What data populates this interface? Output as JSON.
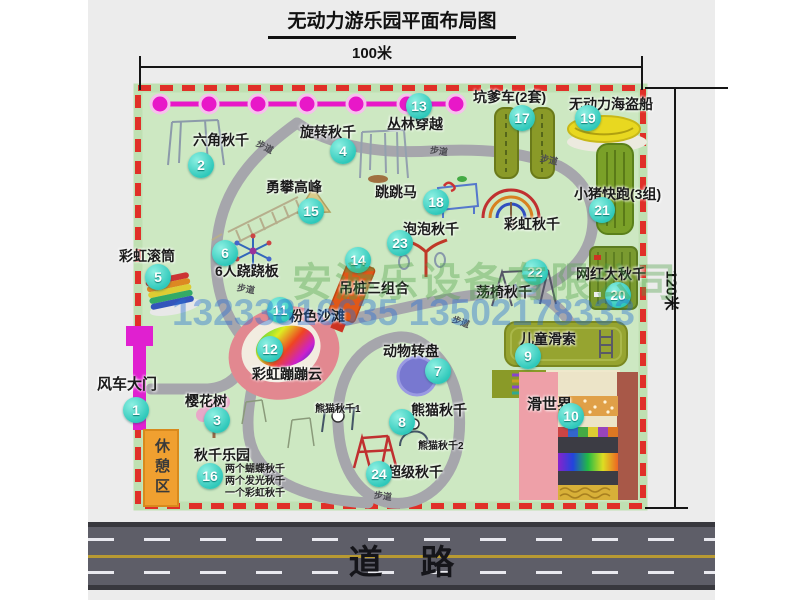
{
  "title": "无动力游乐园平面布局图",
  "dimensions": {
    "width": "100米",
    "height": "120米"
  },
  "road_label": "道    路",
  "walkway_label": "步道",
  "watermark": {
    "company": "安游乐设备有限公司",
    "phone": "13233816635 13502178333"
  },
  "rest_area_label": "休憩区",
  "rainbow_swing_label": "彩虹秋千",
  "panda_swing_1": "熊猫秋千1",
  "panda_swing_2": "熊猫秋千2",
  "swing_park_notes": {
    "n1": "两个蝴蝶秋千",
    "n2": "两个发光秋千",
    "n3": "一个彩虹秋千"
  },
  "attractions": [
    {
      "num": "1",
      "name": "风车大门"
    },
    {
      "num": "2",
      "name": "六角秋千"
    },
    {
      "num": "3",
      "name": "樱花树"
    },
    {
      "num": "4",
      "name": "旋转秋千"
    },
    {
      "num": "5",
      "name": "彩虹滚筒"
    },
    {
      "num": "6",
      "name": "6人跷跷板"
    },
    {
      "num": "7",
      "name": "动物转盘"
    },
    {
      "num": "8",
      "name": "熊猫秋千"
    },
    {
      "num": "9",
      "name": "儿童滑索"
    },
    {
      "num": "10",
      "name": "滑世界"
    },
    {
      "num": "11",
      "name": "粉色沙滩"
    },
    {
      "num": "12",
      "name": "彩虹蹦蹦云"
    },
    {
      "num": "13",
      "name": "丛林穿越"
    },
    {
      "num": "14",
      "name": "吊桩三组合"
    },
    {
      "num": "15",
      "name": "勇攀高峰"
    },
    {
      "num": "16",
      "name": "秋千乐园"
    },
    {
      "num": "17",
      "name": "坑爹车(2套)"
    },
    {
      "num": "18",
      "name": "跳跳马"
    },
    {
      "num": "19",
      "name": "无动力海盗船"
    },
    {
      "num": "20",
      "name": "网红大秋千"
    },
    {
      "num": "21",
      "name": "小猪快跑(3组)"
    },
    {
      "num": "22",
      "name": "荡椅秋千"
    },
    {
      "num": "23",
      "name": "泡泡秋千"
    },
    {
      "num": "24",
      "name": "超级秋千"
    }
  ],
  "colors": {
    "park_fill": "#cde8c2",
    "border_red": "#e03028",
    "badge_teal": "#2ec8ba",
    "zipline_magenta": "#e818c8",
    "road_gray": "#5e5e68",
    "rest_orange": "#f0a030"
  }
}
